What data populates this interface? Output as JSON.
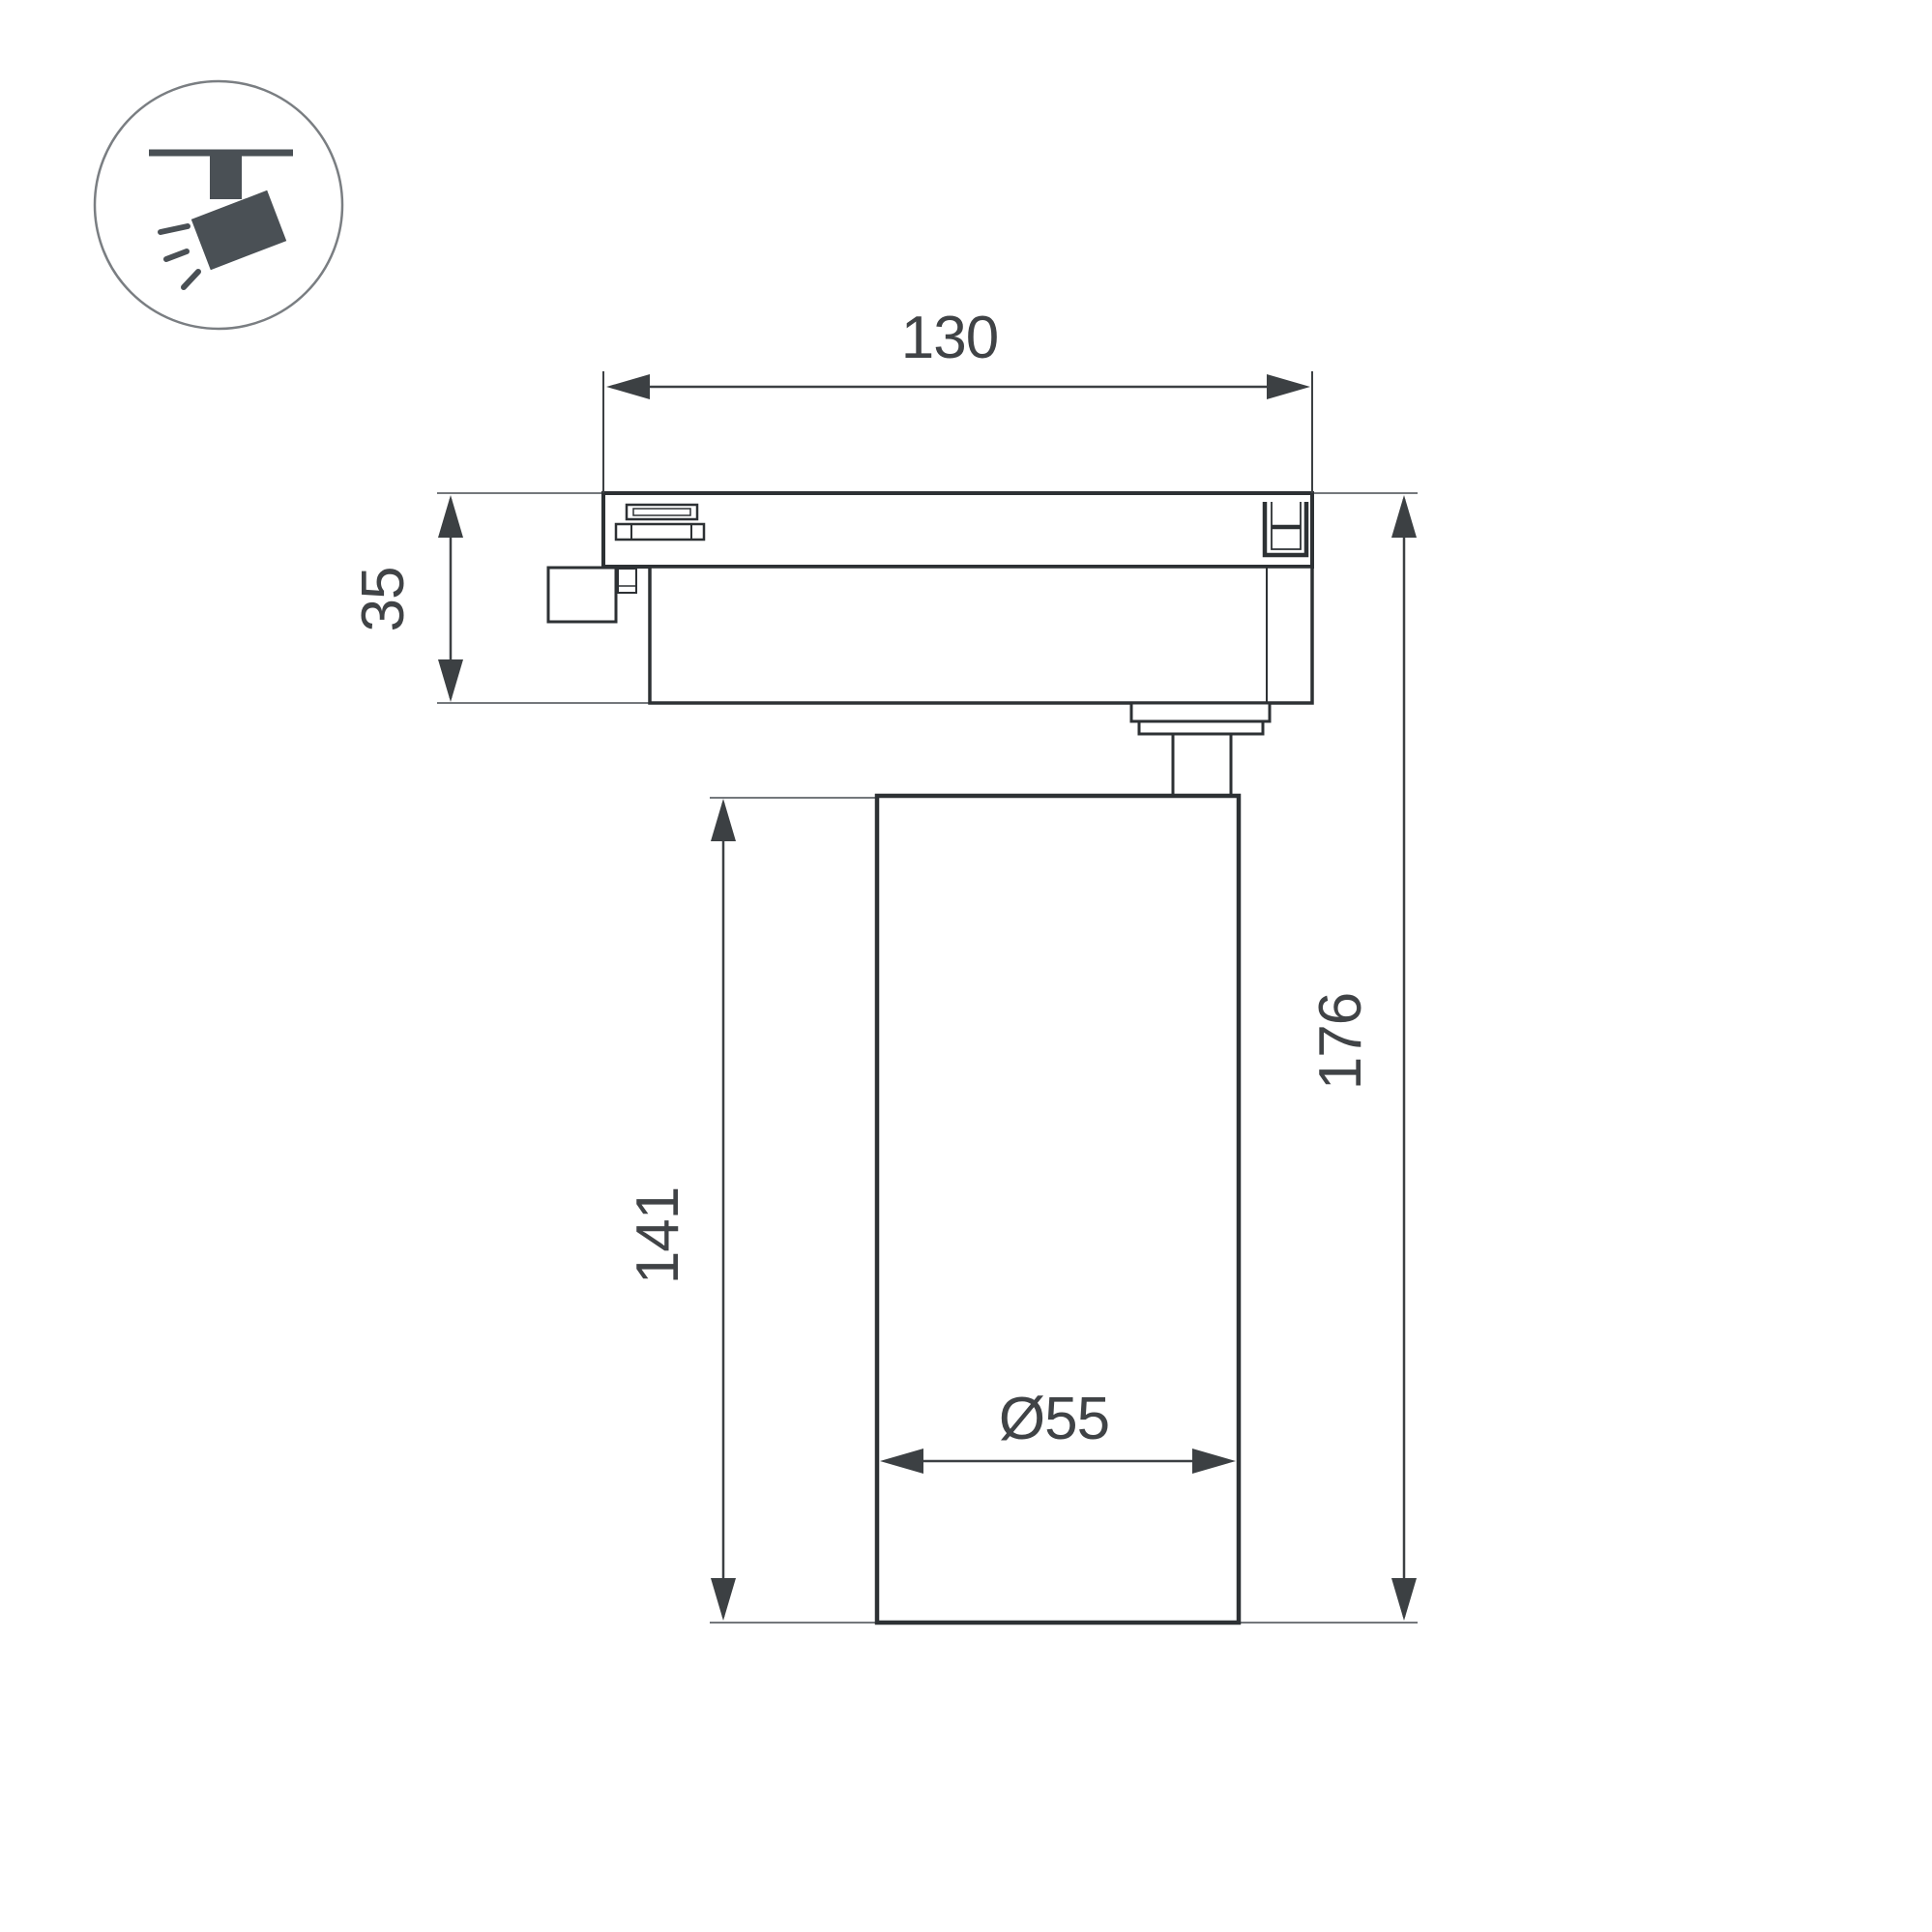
{
  "drawing": {
    "type": "technical-dimension-drawing",
    "subject": "track-mounted spotlight, side view",
    "background_color": "#ffffff",
    "outline_color": "#2d3134",
    "dimension_color": "#3c4043",
    "extension_color": "#74787c",
    "icon_color": "#4a5055",
    "dimensions": {
      "track_adapter_width": "130",
      "track_adapter_height": "35",
      "lamp_body_height": "141",
      "total_height": "176",
      "lamp_body_diameter": "Ø55"
    }
  }
}
